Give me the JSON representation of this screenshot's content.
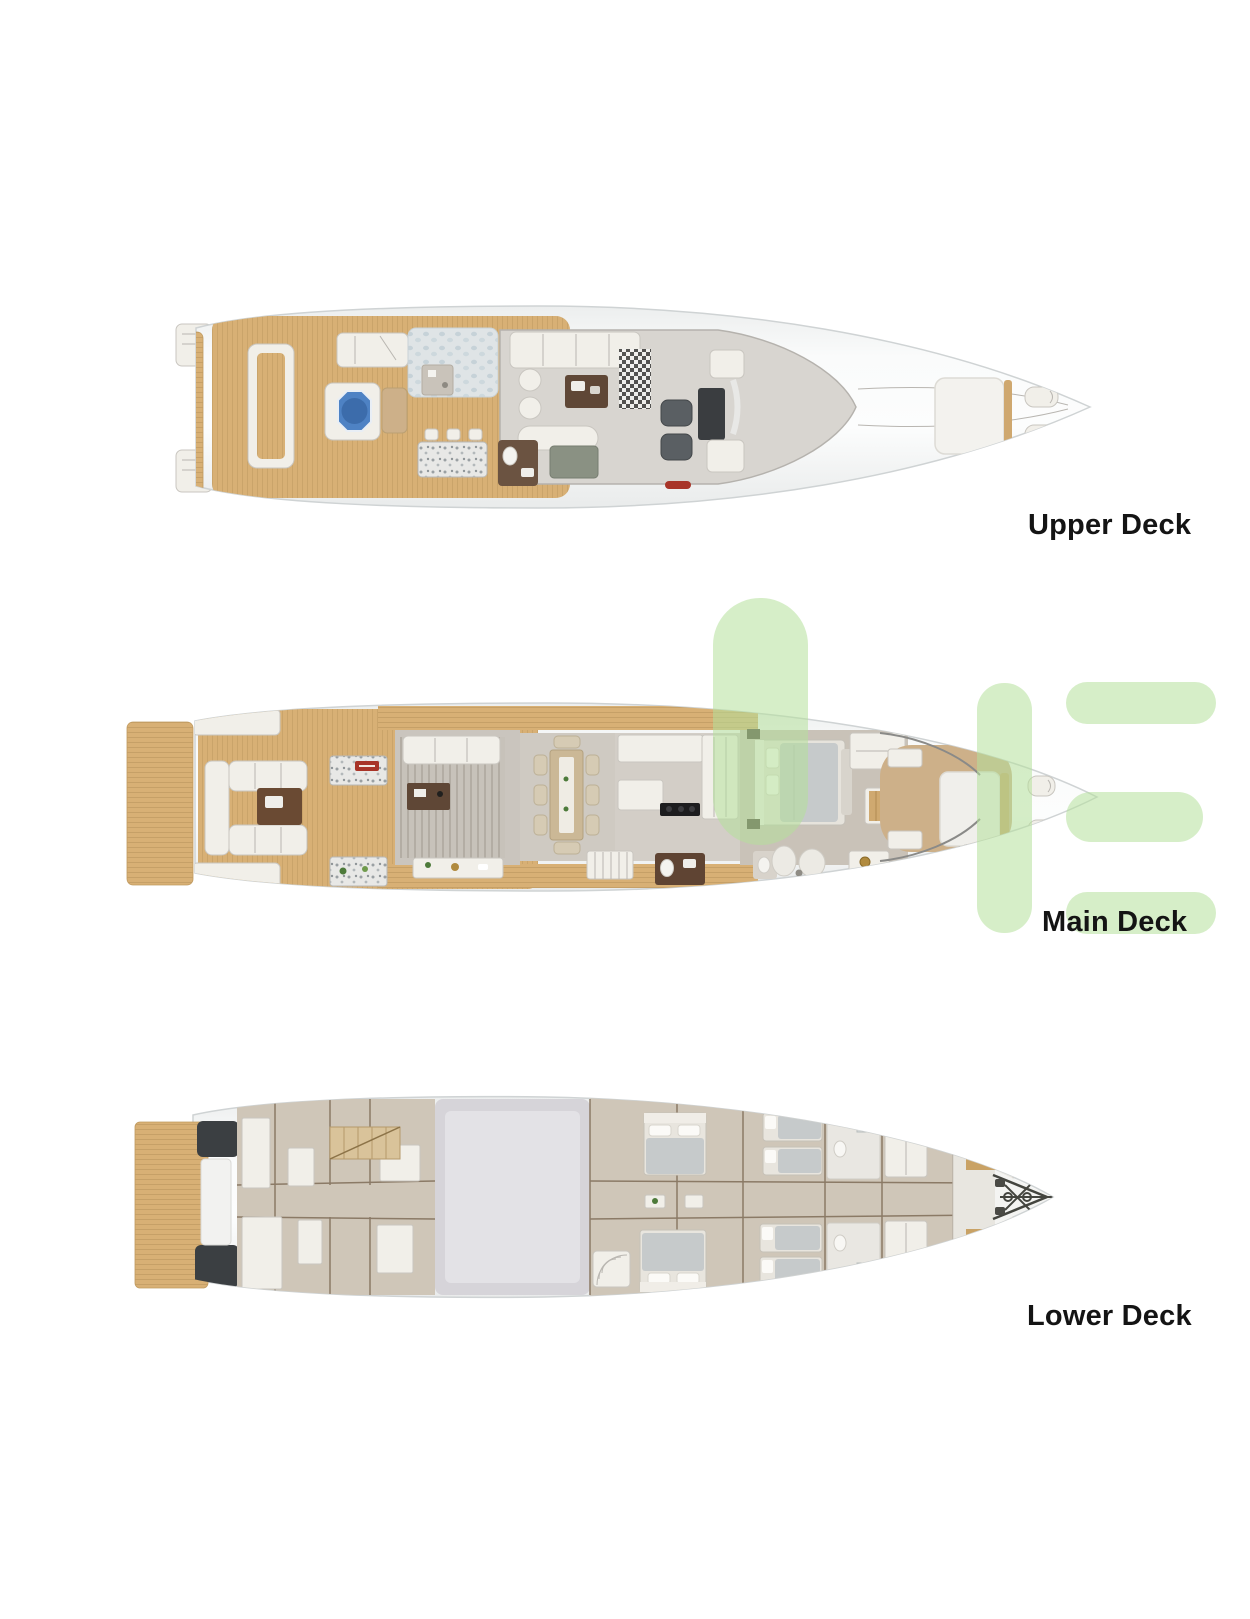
{
  "page": {
    "width": 1250,
    "height": 1619,
    "background": "#ffffff"
  },
  "colors": {
    "page-bg": "#ffffff",
    "label": "#141414",
    "watermark": "#b5e09b",
    "hull-edge": "#cfd3d4",
    "interior": "#d8d5d0",
    "furniture": "#f1efe9",
    "wood": "#d8b075",
    "wood-line": "#bf9a60",
    "pool": "#4e82c4",
    "pool-deep": "#3c6cab",
    "carpet": "#c7c2ba",
    "tan-deck": "#cdb089",
    "dark-wedge": "#3b3f42",
    "engine-room": "#d6d4d9",
    "cabin-floor": "#cfc6b8",
    "duvet": "#c6cacb",
    "brown-wood": "#5f4736",
    "red-sign": "#a83428",
    "gold": "#b08a3e"
  },
  "decks": [
    {
      "id": "upper-deck",
      "label": "Upper Deck"
    },
    {
      "id": "main-deck",
      "label": "Main Deck"
    },
    {
      "id": "lower-deck",
      "label": "Lower Deck"
    }
  ],
  "watermark": {
    "name": "green-logo-watermark"
  }
}
